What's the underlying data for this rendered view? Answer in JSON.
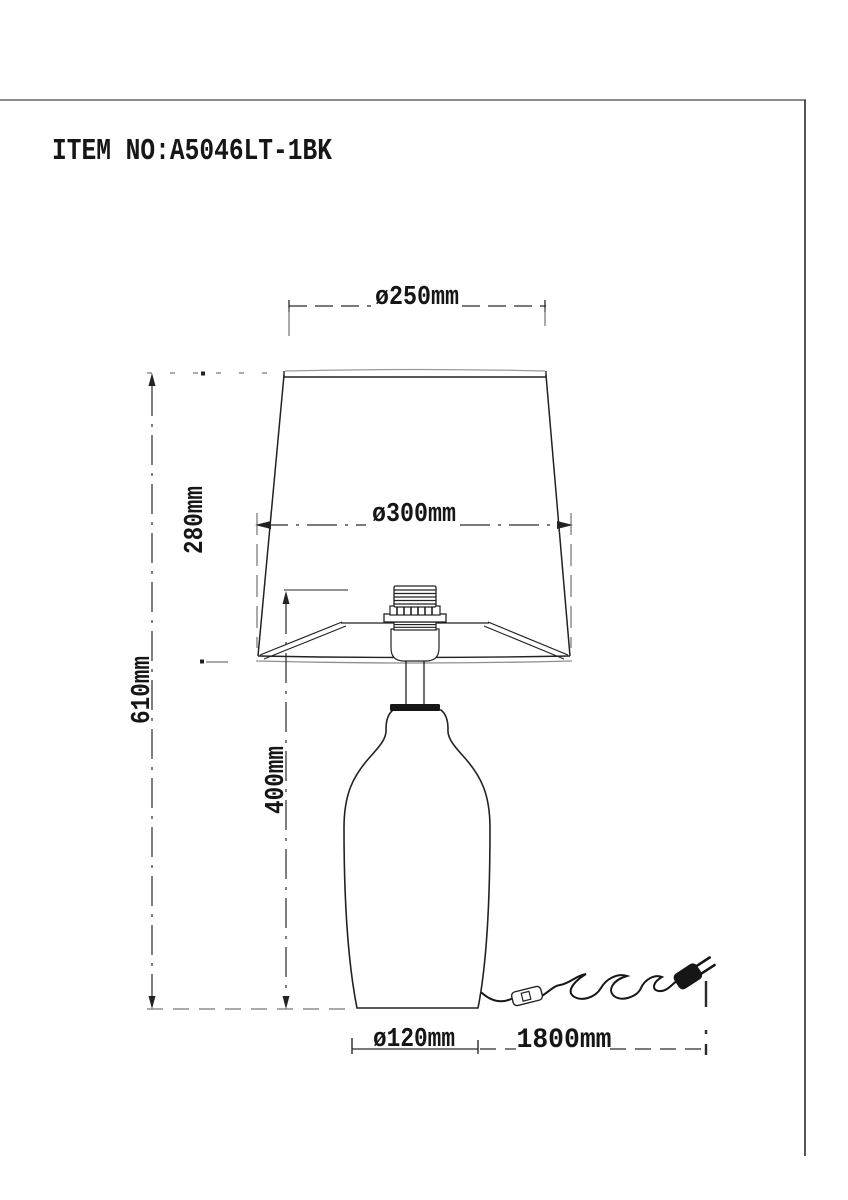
{
  "title_block": {
    "item_number": "ITEM NO:A5046LT-1BK"
  },
  "dimensions": {
    "shade_top_diameter": "ø250mm",
    "shade_bottom_diameter": "ø300mm",
    "shade_height": "280mm",
    "total_height": "610mm",
    "base_and_socket_height": "400mm",
    "base_diameter": "ø120mm",
    "cord_length": "1800mm"
  },
  "colors": {
    "background": "#ffffff",
    "line": "#1f1f1f",
    "thin_line": "#555555",
    "border_top": "#8c8c8c"
  }
}
